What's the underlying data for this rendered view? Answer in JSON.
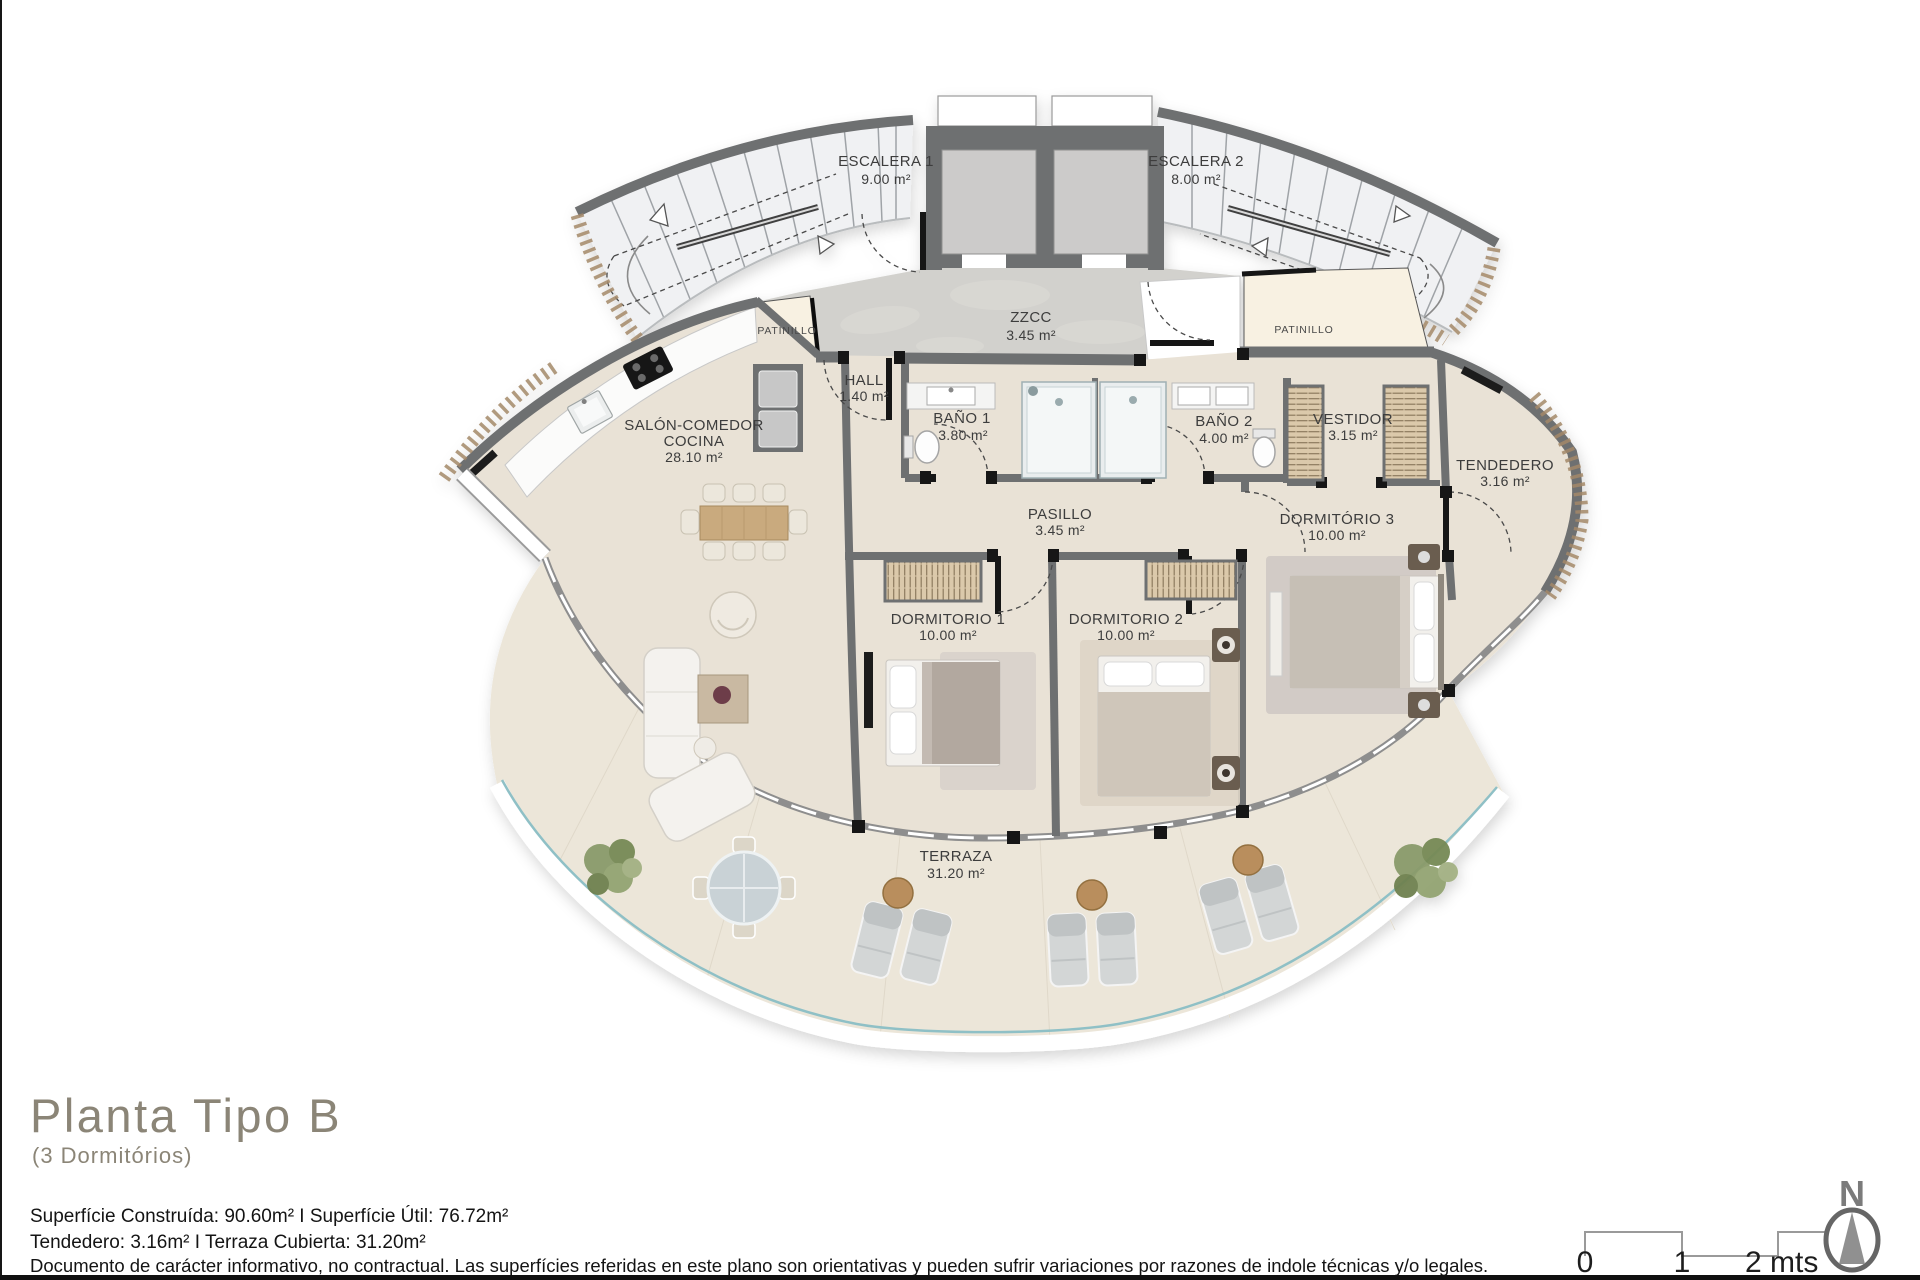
{
  "plan": {
    "rooms": {
      "escalera1": {
        "name": "ESCALERA 1",
        "area": "9.00 m²"
      },
      "escalera2": {
        "name": "ESCALERA 2",
        "area": "8.00 m²"
      },
      "zzcc": {
        "name": "ZZCC",
        "area": "3.45 m²"
      },
      "patinillo_left": {
        "name": "PATINILLO"
      },
      "patinillo_right": {
        "name": "PATINILLO"
      },
      "hall": {
        "name": "HALL",
        "area": "1.40 m²"
      },
      "salon": {
        "name_line1": "SALÓN-COMEDOR",
        "name_line2": "COCINA",
        "area": "28.10 m²"
      },
      "bano1": {
        "name": "BAÑO 1",
        "area": "3.80 m²"
      },
      "bano2": {
        "name": "BAÑO 2",
        "area": "4.00 m²"
      },
      "vestidor": {
        "name": "VESTIDOR",
        "area": "3.15 m²"
      },
      "tendedero": {
        "name": "TENDEDERO",
        "area": "3.16 m²"
      },
      "pasillo": {
        "name": "PASILLO",
        "area": "3.45 m²"
      },
      "dormitorio1": {
        "name": "DORMITORIO 1",
        "area": "10.00 m²"
      },
      "dormitorio2": {
        "name": "DORMITORIO 2",
        "area": "10.00 m²"
      },
      "dormitorio3": {
        "name": "DORMITÓRIO 3",
        "area": "10.00 m²"
      },
      "terraza": {
        "name": "TERRAZA",
        "area": "31.20 m²"
      }
    },
    "colors": {
      "wall": "#6e6f71",
      "floor": "#e9e2d6",
      "terrace": "#ece6d9",
      "glass": "#8fc0c6"
    }
  },
  "footer": {
    "title": "Planta Tipo B",
    "subtitle": "(3 Dormitórios)",
    "areas_line1": "Superfície Construída: 90.60m² I Superfície Útil: 76.72m²",
    "areas_line2": "Tendedero: 3.16m² I Terraza Cubierta: 31.20m²",
    "disclaimer": "Documento de carácter informativo, no contractual. Las superfícies referidas en este plano son orientativas y pueden sufrir variaciones por razones de indole técnicas y/o legales.",
    "scale": {
      "tick0": "0",
      "tick1": "1",
      "tick2": "2 mts"
    },
    "compass": {
      "label": "N"
    }
  }
}
